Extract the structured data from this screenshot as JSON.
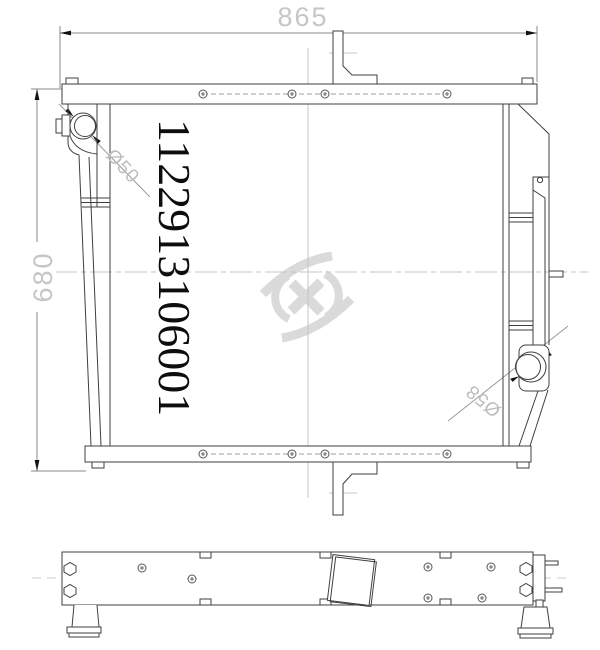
{
  "drawing": {
    "part_number": "1122913106001",
    "dimensions": {
      "overall_width": "865",
      "overall_height": "680"
    },
    "labels": {
      "inlet_diameter": "Ø50",
      "outlet_diameter": "Ø58"
    },
    "watermark_icon": "swirl-logo",
    "colors": {
      "line": "#3f3f3f",
      "dim_line": "#7a7a7a",
      "arrow": "#111111",
      "dim_text": "#c6c6c6",
      "centerline": "#c4c4c4",
      "watermark": "#dadada",
      "part_number_text": "#0d0d0d",
      "background": "#ffffff"
    }
  }
}
